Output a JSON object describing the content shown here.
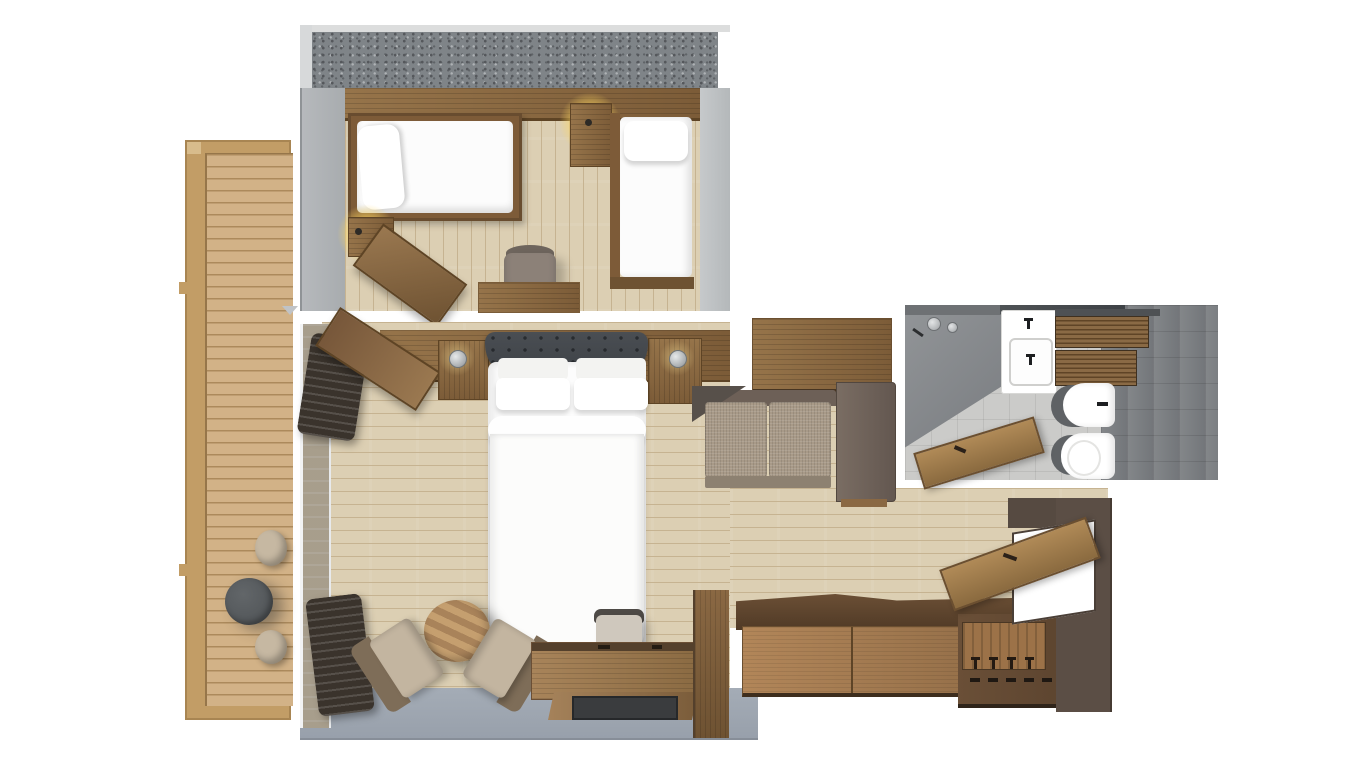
{
  "meta": {
    "type": "3d-floor-plan-rendering",
    "view": "top-down",
    "visible_text": "none"
  },
  "palette": {
    "floor_wood": "#dccfb3",
    "floor_plank_line": "#c6b391",
    "deck_wood": "#d2b287",
    "deck_plank_line": "#ac8a5c",
    "deck_frame": "#c29d66",
    "shelf_wood": "#96744a",
    "shelf_wood_dark": "#7c5c38",
    "cabinet_wood": "#a07c50",
    "cabinet_wood_dark": "#5f4733",
    "door_wood": "#a8854f",
    "wall_light": "#c6c9cb",
    "wall_mid": "#9ba0a4",
    "wall_texture": "#7f8488",
    "wall_blue_gray": "#9aa3ae",
    "bath_floor": "#cbcbc9",
    "bath_floor_dark": "#7b7e81",
    "shower_panel": "#85888b",
    "fixture_white": "#ffffff",
    "fixture_shadow": "#5f6265",
    "sofa_fabric": "#a89a88",
    "sofa_frame": "#6d6057",
    "bed_white": "#fcfcfc",
    "headboard_dark": "#42464b",
    "curtain_dark": "#3a332c",
    "entrance_wall": "#5b4e45",
    "chair_beige": "#c3b5a0",
    "chair_brown": "#7e6d58",
    "table_dark": "#53575a",
    "stool_beige": "#c6b8a2",
    "lamp_glow": "#ffd75e",
    "metal": "#c0c3c6"
  },
  "floorplan": {
    "rooms": [
      {
        "name": "twin-bedroom",
        "position": "top-center",
        "furniture": [
          "single-bed-left",
          "single-bed-right",
          "nightstand-between-beds",
          "nightstand-left",
          "pendant-lamp",
          "pendant-lamp",
          "desk",
          "desk-chair",
          "luggage-bench"
        ]
      },
      {
        "name": "main-bedroom",
        "position": "center",
        "furniture": [
          "double-bed",
          "tufted-headboard",
          "nightstand-left",
          "nightstand-right",
          "wall-sconce",
          "wall-sconce",
          "sofa",
          "armchair",
          "armchair",
          "round-coffee-table",
          "desk",
          "chair",
          "tv-panel",
          "curtains",
          "glass-wall"
        ]
      },
      {
        "name": "terrace",
        "position": "left",
        "furniture": [
          "wood-deck",
          "round-table",
          "stool",
          "stool"
        ]
      },
      {
        "name": "bathroom",
        "position": "top-right",
        "furniture": [
          "shower",
          "shower-heads",
          "vanity-sink",
          "wood-drawer-unit",
          "bidet",
          "toilet",
          "bathroom-door"
        ]
      },
      {
        "name": "entry-corridor",
        "position": "bottom-right",
        "furniture": [
          "sideboard",
          "coat-rack-with-hooks",
          "entrance-door",
          "door-opening"
        ]
      }
    ]
  }
}
